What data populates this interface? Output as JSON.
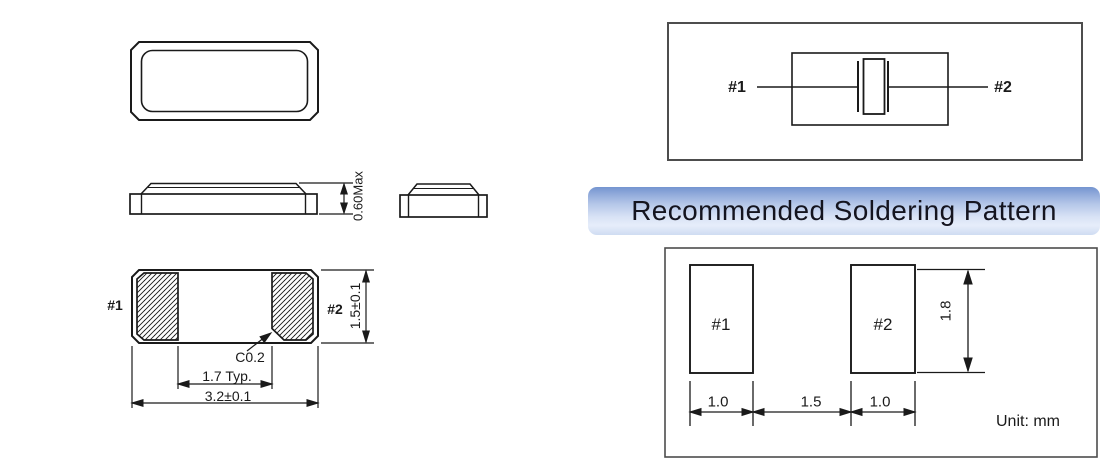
{
  "title_bar": {
    "label": "Recommended Soldering Pattern"
  },
  "dimension_views": {
    "side_view": {
      "height": "0.60Max"
    },
    "bottom_view": {
      "pad1": "#1",
      "pad2": "#2",
      "chamfer": "C0.2",
      "inner_span": "1.7 Typ.",
      "length": "3.2±0.1",
      "width": "1.5±0.1"
    }
  },
  "equivalent_circuit": {
    "terminal_1": "#1",
    "terminal_2": "#2"
  },
  "soldering_pattern": {
    "pad1": "#1",
    "pad2": "#2",
    "dim_pad1_width": "1.0",
    "dim_gap": "1.5",
    "dim_pad2_width": "1.0",
    "dim_pad_height": "1.8",
    "unit": "Unit: mm"
  },
  "colors": {
    "line": "#1a1a1a",
    "box_border": "#4d4d4d",
    "header_gradient_top": "#7495d0",
    "header_gradient_bottom": "#cfdcf2",
    "header_text": "#14141f"
  }
}
